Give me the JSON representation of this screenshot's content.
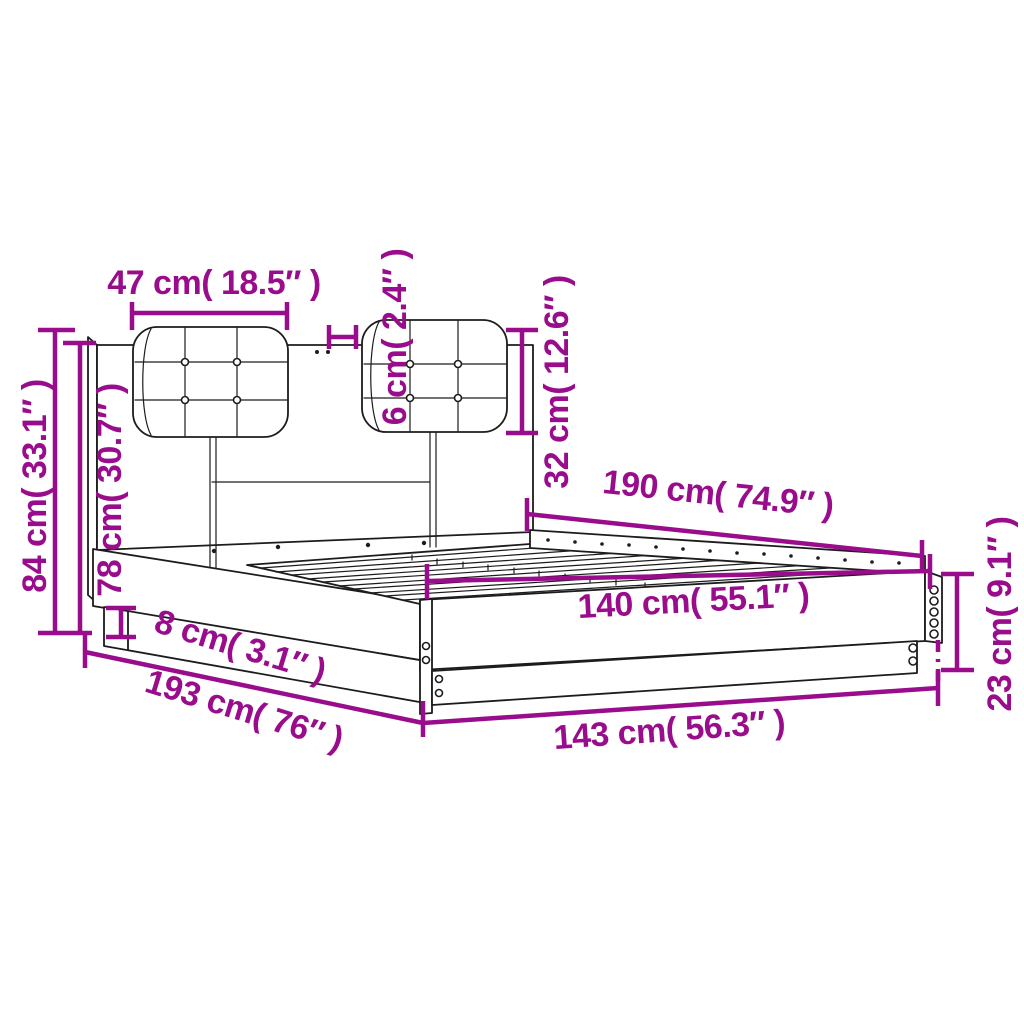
{
  "diagram": {
    "title": "Bed frame with headboard — dimension diagram",
    "product": "bed-frame-with-headboard-and-cushions",
    "units": [
      "cm",
      "inches"
    ],
    "colors": {
      "dimension": "#990d8c",
      "line": "#1c1c1c",
      "background": "#ffffff"
    },
    "dimensions": [
      {
        "name": "headboard-cushion-width",
        "value_cm": 47,
        "value_in": 18.5,
        "label": "47 cm( 18.5″ )"
      },
      {
        "name": "cushion-offset-depth",
        "value_cm": 6,
        "value_in": 2.4,
        "label": "6 cm( 2.4″ )"
      },
      {
        "name": "cushion-height",
        "value_cm": 32,
        "value_in": 12.6,
        "label": "32 cm( 12.6″ )"
      },
      {
        "name": "headboard-total-height",
        "value_cm": 84,
        "value_in": 33.1,
        "label": "84 cm( 33.1″ )"
      },
      {
        "name": "headboard-panel-height",
        "value_cm": 78,
        "value_in": 30.7,
        "label": "78 cm( 30.7″ )"
      },
      {
        "name": "plinth-height",
        "value_cm": 8,
        "value_in": 3.1,
        "label": "8 cm( 3.1″ )"
      },
      {
        "name": "total-length",
        "value_cm": 193,
        "value_in": 76,
        "label": "193 cm( 76″ )"
      },
      {
        "name": "frame-length",
        "value_cm": 190,
        "value_in": 74.9,
        "label": "190 cm( 74.9″ )"
      },
      {
        "name": "slat-area-width",
        "value_cm": 140,
        "value_in": 55.1,
        "label": "140 cm( 55.1″ )"
      },
      {
        "name": "frame-width",
        "value_cm": 143,
        "value_in": 56.3,
        "label": "143 cm( 56.3″ )"
      },
      {
        "name": "side-rail-height",
        "value_cm": 23,
        "value_in": 9.1,
        "label": "23 cm( 9.1″ )"
      }
    ]
  }
}
